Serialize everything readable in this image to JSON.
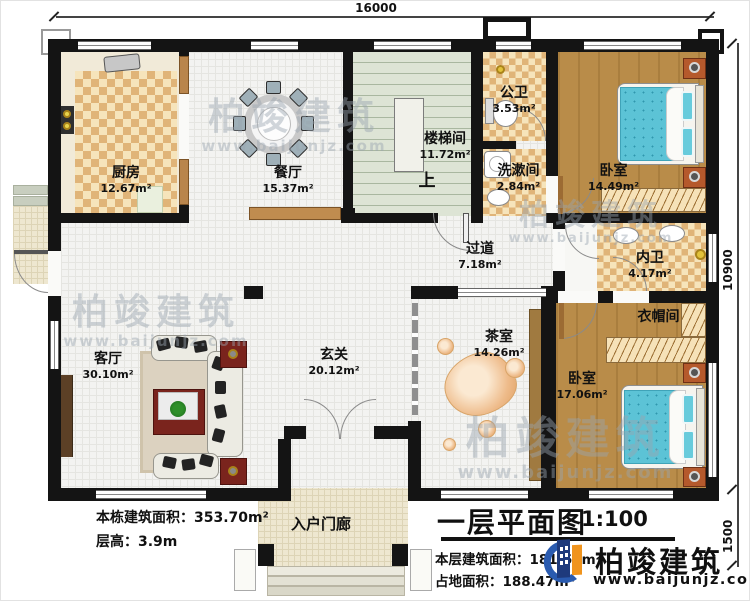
{
  "dims": {
    "top": "16000",
    "right_main": "10900",
    "right_porch": "1500"
  },
  "rooms": [
    {
      "key": "kitchen",
      "name": "厨房",
      "area": "12.67m²"
    },
    {
      "key": "dining",
      "name": "餐厅",
      "area": "15.37m²"
    },
    {
      "key": "stairwell",
      "name": "楼梯间",
      "area": "11.72m²"
    },
    {
      "key": "public-bath",
      "name": "公卫",
      "area": "3.53m²"
    },
    {
      "key": "washroom",
      "name": "洗漱间",
      "area": "2.84m²"
    },
    {
      "key": "bedroom-top",
      "name": "卧室",
      "area": "14.49m²"
    },
    {
      "key": "inner-bath",
      "name": "内卫",
      "area": "4.17m²"
    },
    {
      "key": "cloakroom",
      "name": "衣帽间",
      "area": ""
    },
    {
      "key": "bedroom-bottom",
      "name": "卧室",
      "area": "17.06m²"
    },
    {
      "key": "tea-room",
      "name": "茶室",
      "area": "14.26m²"
    },
    {
      "key": "corridor",
      "name": "过道",
      "area": "7.18m²"
    },
    {
      "key": "foyer",
      "name": "玄关",
      "area": "20.12m²"
    },
    {
      "key": "living-room",
      "name": "客厅",
      "area": "30.10m²"
    },
    {
      "key": "entry-porch",
      "name": "入户门廊",
      "area": ""
    }
  ],
  "stair_up": "上",
  "info_block": {
    "building_area": "本栋建筑面积：353.70m²",
    "floor_height": "层高：3.9m"
  },
  "title_block": {
    "title": "一层平面图",
    "scale": "1:100",
    "floor_area": "本层建筑面积：181.69m²",
    "footprint": "占地面积：188.47m²"
  },
  "brand": {
    "name": "柏竣建筑",
    "website": "www.baijunjz.com"
  },
  "watermark": {
    "text": "柏竣建筑",
    "website": "www.baijunjz.com"
  },
  "colors": {
    "wall": "#141414",
    "wood_floor": "#b98c49",
    "tile_light": "#f6e4bb",
    "tile_dark": "#e0b478",
    "stair_floor": "#dde4d5",
    "open_floor": "#f3f3f1",
    "porch_floor": "#eee7d0",
    "bed": "#5cc3d6",
    "logo_blue": "#2a5bb0",
    "logo_navy": "#1e3a7c",
    "logo_orange": "#f0941d"
  }
}
